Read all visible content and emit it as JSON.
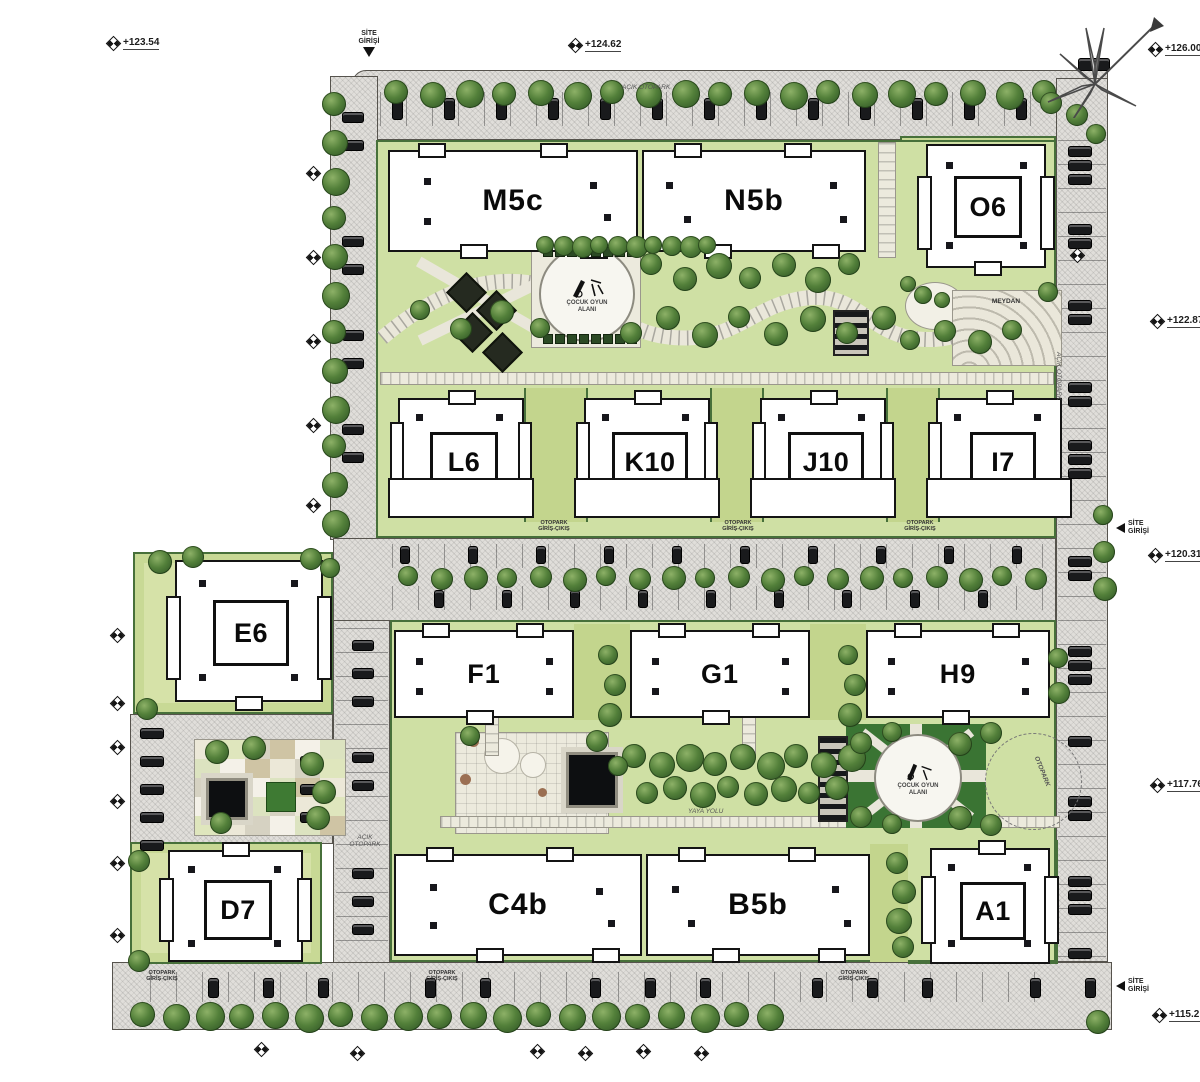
{
  "title": "Residential site plan",
  "buildings": [
    "M5c",
    "N5b",
    "O6",
    "L6",
    "K10",
    "J10",
    "I7",
    "E6",
    "F1",
    "G1",
    "H9",
    "D7",
    "C4b",
    "B5b",
    "A1"
  ],
  "elevations": [
    "+123.54",
    "+124.62",
    "+126.00",
    "+122.87",
    "+120.31",
    "+117.76",
    "+115.21"
  ],
  "entrance_label": "SİTE GİRİŞİ",
  "labels": {
    "playground": "ÇOCUK OYUN ALANI",
    "plaza": "MEYDAN",
    "parking": "OTOPARK",
    "open_parking": "AÇIK OTOPARK",
    "walkway": "YAYA YOLU",
    "parking_gate": "OTOPARK GİRİŞ-ÇIKIŞ"
  },
  "colors": {
    "road": "#e0deda",
    "lawn": "#d6e2a8",
    "lawn_dark": "#c3d58d",
    "hedge": "#44703a",
    "paving": "#eceadd",
    "building": "#ffffff",
    "ink": "#141414",
    "tree": "#53803a",
    "water": "#0d0f11"
  }
}
